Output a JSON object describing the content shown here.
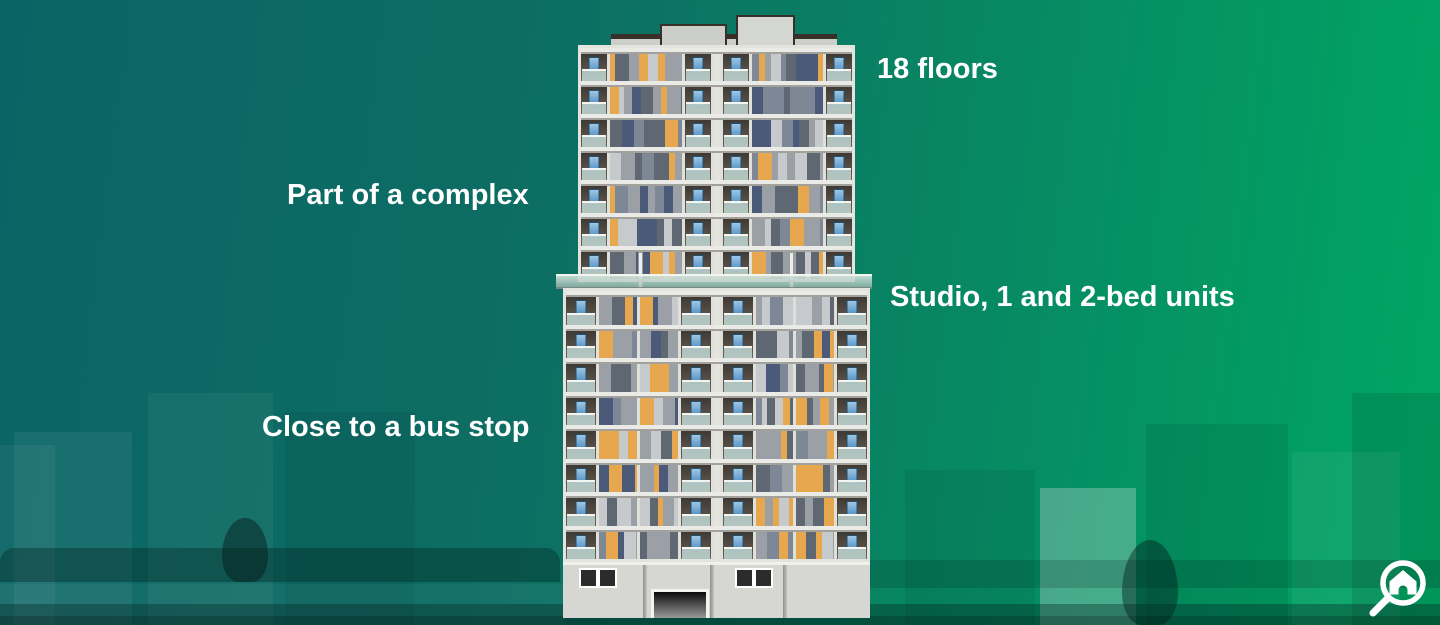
{
  "annotations": {
    "floors": "18 floors",
    "complex": "Part of a complex",
    "units": "Studio, 1 and 2-bed units",
    "bus_stop": "Close to a bus stop"
  },
  "background": {
    "bg_left": "#0a6465",
    "bg_right": "#00a763",
    "text": "#ffffff"
  },
  "logo": {
    "name": "magnifier-house-logo",
    "color": "#ffffff"
  },
  "building": {
    "tower_floors": 7,
    "podium_floors": 8,
    "palette": {
      "orange": "#e7a74f",
      "gray": "#9aa0a6",
      "slate": "#5f6773",
      "light": "#c6cacd",
      "steel": "#7e8795",
      "navy": "#4a5a78",
      "frame": "#e3e4de",
      "units_bg": "#dfe0da",
      "balcony_top": "#3e3933",
      "balcony_bottom": "#6a645c",
      "glass": "#bcd6d2",
      "window": "#4e8fc2",
      "slab": "#eaebe6",
      "ground": "#d6d7d2",
      "roof": "#cbcec9",
      "dark": "#2f2a26"
    }
  }
}
